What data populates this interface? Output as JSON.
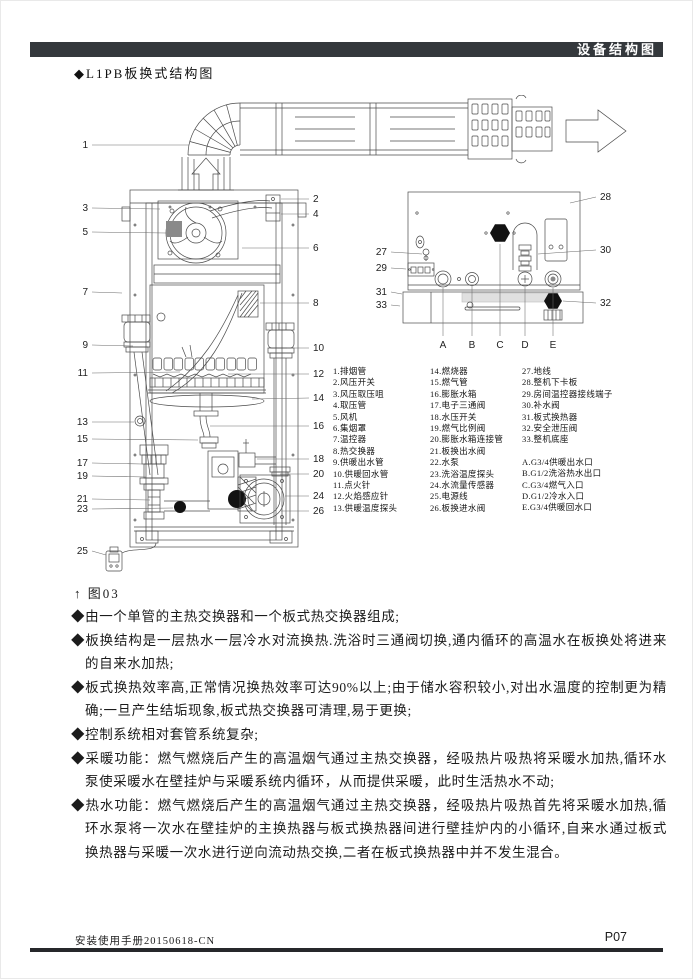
{
  "page": {
    "header_title": "设备结构图",
    "section_title": "◆L1PB板换式结构图",
    "figure_caption": "↑ 图03",
    "footer_left": "安装使用手册20150618-CN",
    "footer_page": "P07"
  },
  "colors": {
    "header_bar_bg": "#34383c",
    "footer_rule": "#26282b",
    "drawing_line": "#4a4a4a"
  },
  "parts_list": {
    "column1": [
      "1.排烟管",
      "2.风压开关",
      "3.风压取压咀",
      "4.取压管",
      "5.风机",
      "6.集烟罩",
      "7.温控器",
      "8.热交换器",
      "9.供暖出水管",
      "10.供暖回水管",
      "11.点火针",
      "12.火焰感应针",
      "13.供暖温度探头"
    ],
    "column2": [
      "14.燃烧器",
      "15.燃气管",
      "16.膨胀水箱",
      "17.电子三通阀",
      "18.水压开关",
      "19.燃气比例阀",
      "20.膨胀水箱连接管",
      "21.板换出水阀",
      "22.水泵",
      "23.洗浴温度探头",
      "24.水流量传感器",
      "25.电源线",
      "26.板换进水阀"
    ],
    "column3": [
      "27.地线",
      "28.整机下卡板",
      "29.房间温控器接线端子",
      "30.补水阀",
      "31.板式换热器",
      "32.安全泄压阀",
      "33.整机底座"
    ],
    "ports": [
      "A.G3/4供暖出水口",
      "B.G1/2洗浴热水出口",
      "C.G3/4燃气入口",
      "D.G1/2冷水入口",
      "E.G3/4供暖回水口"
    ]
  },
  "bullets": [
    "◆由一个单管的主热交换器和一个板式热交换器组成;",
    "◆板换结构是一层热水一层冷水对流换热.洗浴时三通阀切换,通内循环的高温水在板换处将进来的自来水加热;",
    "◆板式换热效率高,正常情况换热效率可达90%以上;由于储水容积较小,对出水温度的控制更为精确;一旦产生结垢现象,板式热交换器可清理,易于更换;",
    "◆控制系统相对套管系统复杂;",
    "◆采暖功能：燃气燃烧后产生的高温烟气通过主热交换器，经吸热片吸热将采暖水加热,循环水泵使采暖水在壁挂炉与采暖系统内循环，从而提供采暖，此时生活热水不动;",
    "◆热水功能：燃气燃烧后产生的高温烟气通过主热交换器，经吸热片吸热首先将采暖水加热,循环水泵将一次水在壁挂炉的主换热器与板式换热器间进行壁挂炉内的小循环,自来水通过板式换热器与采暖一次水进行逆向流动热交换,二者在板式换热器中并不发生混合。"
  ],
  "diagram": {
    "callouts": [
      {
        "t": "1",
        "x": 28,
        "y": 53,
        "a": "end",
        "l": [
          32,
          50,
          129,
          50
        ]
      },
      {
        "t": "3",
        "x": 28,
        "y": 116,
        "a": "end",
        "l": [
          32,
          113,
          100,
          114
        ]
      },
      {
        "t": "5",
        "x": 28,
        "y": 140,
        "a": "end",
        "l": [
          32,
          137,
          106,
          138
        ]
      },
      {
        "t": "7",
        "x": 28,
        "y": 200,
        "a": "end",
        "l": [
          32,
          197,
          62,
          198
        ]
      },
      {
        "t": "9",
        "x": 28,
        "y": 253,
        "a": "end",
        "l": [
          32,
          250,
          73,
          251
        ]
      },
      {
        "t": "11",
        "x": 28,
        "y": 281,
        "a": "end",
        "l": [
          32,
          278,
          120,
          277
        ]
      },
      {
        "t": "13",
        "x": 28,
        "y": 330,
        "a": "end",
        "l": [
          32,
          327,
          74,
          327
        ]
      },
      {
        "t": "15",
        "x": 28,
        "y": 347,
        "a": "end",
        "l": [
          32,
          344,
          138,
          345
        ]
      },
      {
        "t": "17",
        "x": 28,
        "y": 371,
        "a": "end",
        "l": [
          32,
          368,
          82,
          369
        ]
      },
      {
        "t": "19",
        "x": 28,
        "y": 384,
        "a": "end",
        "l": [
          32,
          381,
          86,
          382
        ]
      },
      {
        "t": "21",
        "x": 28,
        "y": 407,
        "a": "end",
        "l": [
          32,
          404,
          90,
          405
        ]
      },
      {
        "t": "23",
        "x": 28,
        "y": 417,
        "a": "end",
        "l": [
          32,
          414,
          113,
          413
        ]
      },
      {
        "t": "25",
        "x": 28,
        "y": 459,
        "a": "end",
        "l": [
          32,
          456,
          46,
          460
        ]
      },
      {
        "t": "2",
        "x": 253,
        "y": 107,
        "a": "start",
        "l": [
          221,
          104,
          249,
          104
        ]
      },
      {
        "t": "4",
        "x": 253,
        "y": 122,
        "a": "start",
        "l": [
          221,
          119,
          249,
          119
        ]
      },
      {
        "t": "6",
        "x": 253,
        "y": 156,
        "a": "start",
        "l": [
          182,
          153,
          249,
          153
        ]
      },
      {
        "t": "8",
        "x": 253,
        "y": 211,
        "a": "start",
        "s": 9,
        "l": [
          200,
          208,
          249,
          208
        ]
      },
      {
        "t": "10",
        "x": 253,
        "y": 256,
        "a": "start",
        "l": [
          227,
          253,
          249,
          253
        ]
      },
      {
        "t": "12",
        "x": 253,
        "y": 282,
        "a": "start",
        "l": [
          168,
          279,
          249,
          279
        ]
      },
      {
        "t": "14",
        "x": 253,
        "y": 306,
        "a": "start",
        "l": [
          192,
          304,
          249,
          303
        ]
      },
      {
        "t": "16",
        "x": 253,
        "y": 334,
        "a": "start",
        "l": [
          150,
          331,
          249,
          331
        ]
      },
      {
        "t": "18",
        "x": 253,
        "y": 367,
        "a": "start",
        "l": [
          197,
          364,
          249,
          364
        ]
      },
      {
        "t": "20",
        "x": 253,
        "y": 382,
        "a": "start",
        "l": [
          220,
          379,
          249,
          379
        ]
      },
      {
        "t": "24",
        "x": 253,
        "y": 404,
        "a": "start",
        "l": [
          225,
          401,
          249,
          401
        ]
      },
      {
        "t": "26",
        "x": 253,
        "y": 419,
        "a": "start",
        "l": [
          221,
          416,
          249,
          416
        ]
      },
      {
        "t": "27",
        "x": 327,
        "y": 160,
        "a": "end",
        "l": [
          331,
          157,
          362,
          159
        ]
      },
      {
        "t": "29",
        "x": 327,
        "y": 176,
        "a": "end",
        "l": [
          331,
          173,
          346,
          174
        ]
      },
      {
        "t": "31",
        "x": 327,
        "y": 200,
        "a": "end",
        "l": [
          331,
          197,
          342,
          199
        ]
      },
      {
        "t": "33",
        "x": 327,
        "y": 213,
        "a": "end",
        "l": [
          331,
          210,
          340,
          211
        ]
      },
      {
        "t": "28",
        "x": 540,
        "y": 105,
        "a": "start",
        "l": [
          510,
          108,
          536,
          102
        ]
      },
      {
        "t": "30",
        "x": 540,
        "y": 158,
        "a": "start",
        "l": [
          478,
          159,
          536,
          155
        ]
      },
      {
        "t": "32",
        "x": 540,
        "y": 211,
        "a": "start",
        "l": [
          503,
          206,
          536,
          208
        ]
      },
      {
        "t": "A",
        "x": 383,
        "y": 253,
        "a": "middle",
        "s": 11,
        "l": [
          383,
          193,
          383,
          241
        ]
      },
      {
        "t": "B",
        "x": 412,
        "y": 253,
        "a": "middle",
        "s": 11,
        "l": [
          412,
          191,
          412,
          241
        ]
      },
      {
        "t": "C",
        "x": 440,
        "y": 253,
        "a": "middle",
        "s": 11,
        "l": [
          440,
          149,
          440,
          241
        ]
      },
      {
        "t": "D",
        "x": 465,
        "y": 253,
        "a": "middle",
        "s": 11,
        "l": [
          465,
          192,
          465,
          241
        ]
      },
      {
        "t": "E",
        "x": 493,
        "y": 253,
        "a": "middle",
        "s": 11,
        "l": [
          493,
          193,
          493,
          241
        ]
      }
    ]
  }
}
